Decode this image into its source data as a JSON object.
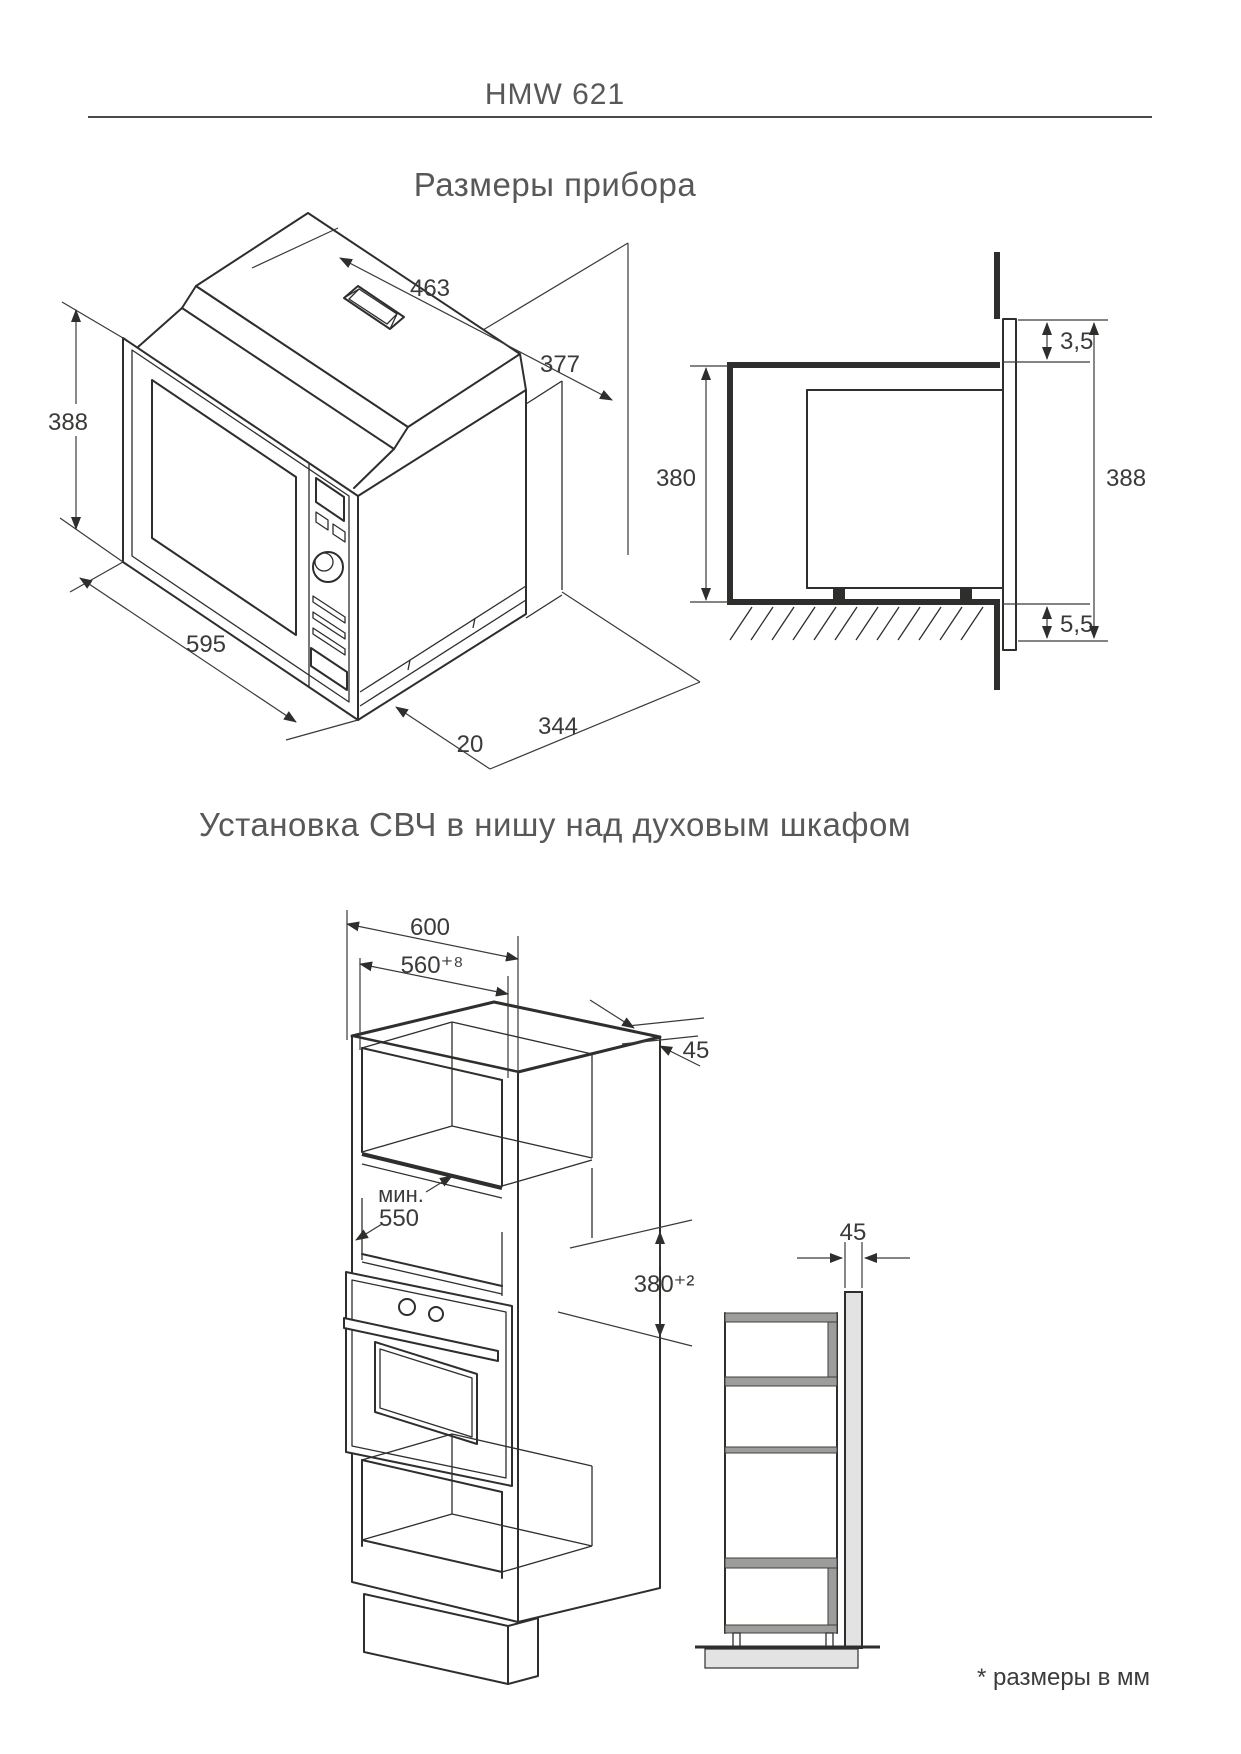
{
  "header": {
    "model": "HMW 621"
  },
  "sections": {
    "device_dims_heading": "Размеры прибора",
    "install_heading": "Установка СВЧ в нишу над духовым шкафом"
  },
  "footnote": "* размеры в мм",
  "device_drawing": {
    "depth_top": "463",
    "height_back": "377",
    "height_front": "388",
    "width_front": "595",
    "base_step": "20",
    "base_depth": "344"
  },
  "section_drawing": {
    "gap_top": "3,5",
    "niche_height": "380",
    "front_height": "388",
    "gap_bottom": "5,5"
  },
  "cabinet_drawing": {
    "cabinet_width": "600",
    "niche_width": "560⁺⁸",
    "panel_thickness": "45",
    "depth_min_prefix": "мин.",
    "depth_min_value": "550",
    "niche_height": "380⁺²"
  },
  "side_drawing": {
    "front_panel_thickness": "45"
  }
}
